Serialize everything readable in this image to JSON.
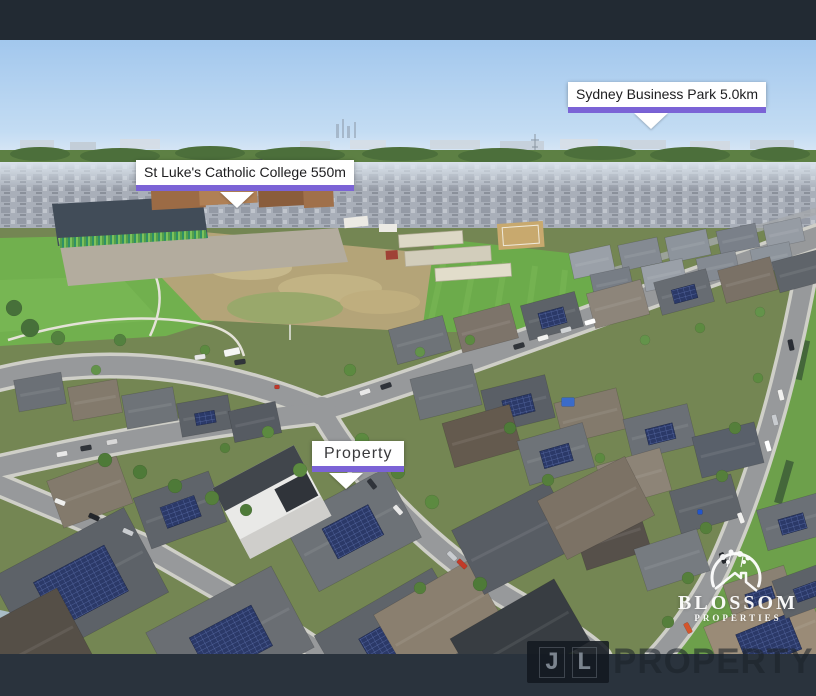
{
  "annotations": {
    "business_park": {
      "label": "Sydney Business Park 5.0km"
    },
    "college": {
      "label": "St Luke's Catholic College 550m"
    },
    "property": {
      "label": "Property"
    }
  },
  "branding": {
    "blossom": {
      "name": "BLOSSOM",
      "tagline": "PROPERTIES"
    },
    "watermark": {
      "letter_j": "J",
      "letter_l": "L",
      "wordmark": "PROPERTY"
    }
  },
  "colors": {
    "accent_purple": "#7b63d6",
    "top_bar": "#222a33",
    "bottom_bar": "#2a333d",
    "label_bg": "#ffffff",
    "label_text": "#1d1d1f",
    "sky": "#a2c7ed",
    "grass": "#6fae4c",
    "dirt_field": "#b4a478",
    "solar_panel": "#2b3968",
    "watermark_dark": "rgba(28,34,42,0.58)"
  }
}
